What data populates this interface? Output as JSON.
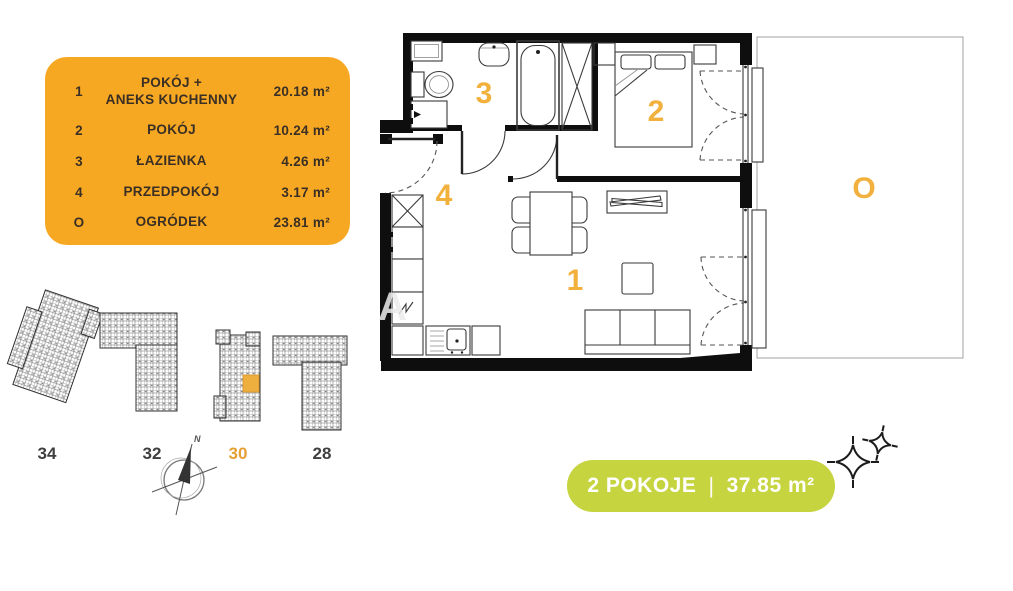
{
  "legend": {
    "rows": [
      {
        "num": "1",
        "name": "POKÓJ +\nANEKS KUCHENNY",
        "area": "20.18 m²"
      },
      {
        "num": "2",
        "name": "POKÓJ",
        "area": "10.24 m²"
      },
      {
        "num": "3",
        "name": "ŁAZIENKA",
        "area": "4.26 m²"
      },
      {
        "num": "4",
        "name": "PRZEDPOKÓJ",
        "area": "3.17 m²"
      },
      {
        "num": "O",
        "name": "OGRÓDEK",
        "area": "23.81 m²"
      }
    ]
  },
  "plan": {
    "labels": {
      "living": "1",
      "bedroom": "2",
      "bathroom": "3",
      "hall": "4",
      "garden": "O"
    },
    "watermark": "A"
  },
  "site": {
    "buildings": [
      {
        "label": "34"
      },
      {
        "label": "32"
      },
      {
        "label": "30"
      },
      {
        "label": "28"
      }
    ],
    "highlighted": "30",
    "compass": {
      "north": "N"
    }
  },
  "badge": {
    "rooms": "2 POKOJE",
    "separator": "|",
    "area": "37.85 m²"
  },
  "colors": {
    "legend_orange": "#F7A823",
    "plan_number_orange": "#F2B03C",
    "badge_green": "#C6D440",
    "legend_text": "#3A2F24",
    "wall_black": "#0e0e0e"
  }
}
